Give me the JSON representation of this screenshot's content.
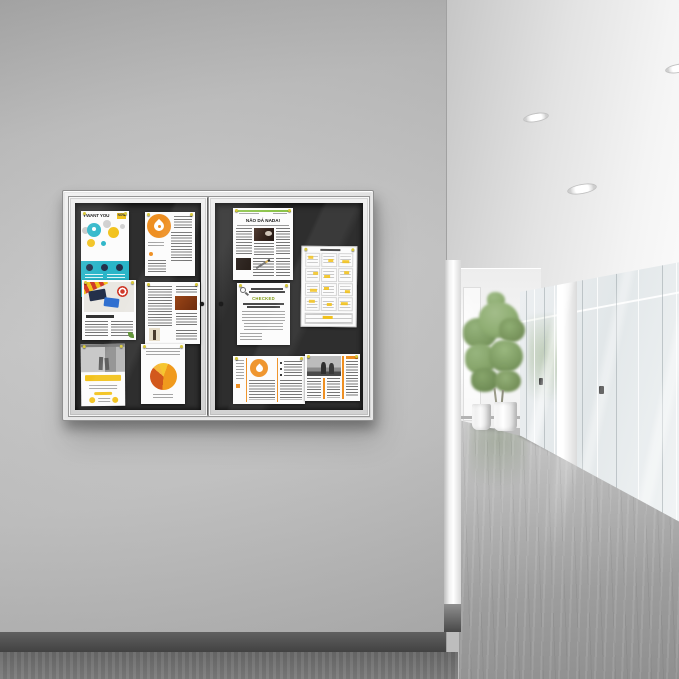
{
  "scene": {
    "title": "Enclosed two-door bulletin board on a wall beside a bright office hallway",
    "colors": {
      "wall": "#c3c3c3",
      "wall-dark": "#a6a6a6",
      "baseboard": "#4e4e4e",
      "floor-left": "#6d6d6d",
      "frame": "#e3e3e3",
      "frame-dark": "#9a9a9a",
      "felt": "#2e2e2e",
      "ceiling": "#dedede",
      "far-wall": "#f4f4f4",
      "glass": "#e8edef",
      "hall-floor": "#a6a6a6",
      "pillar": "#f6f6f6",
      "plant": "#7d9b62",
      "plant-dark": "#66844e",
      "pot": "#ececec",
      "accent-orange": "#ee8f22",
      "accent-teal": "#2ab5c8",
      "accent-yellow": "#f2c21c",
      "accent-navy": "#24304a",
      "accent-green": "#8bc34a",
      "accent-olive": "#7c9a0e",
      "accent-red": "#cf3a2a",
      "accent-blue": "#2f6fd0",
      "photo-brown": "#9a4516",
      "pin-yellow": "#d9c93a"
    }
  },
  "posters": {
    "want_you": {
      "title": "I WANT YOU",
      "badge": "NOW"
    },
    "newsletter": {
      "title": "NÃO DÁ NADA!"
    },
    "checked": {
      "heading": "CHECKED"
    }
  }
}
